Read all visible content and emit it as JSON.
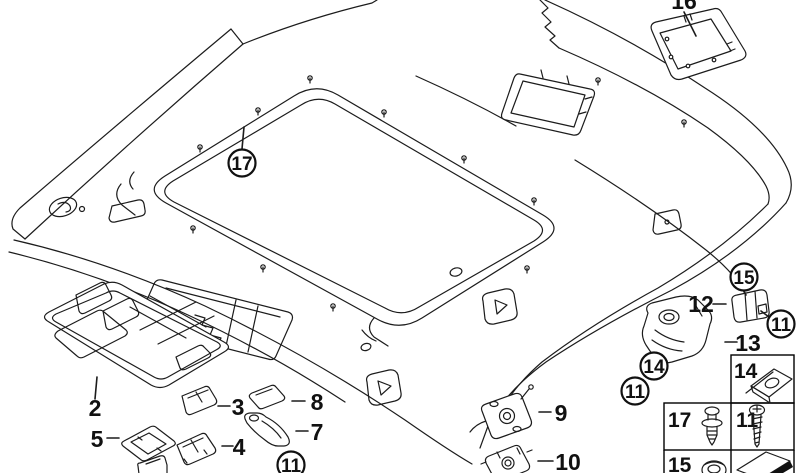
{
  "diagram": {
    "ink": "#1c1c1c",
    "callouts": {
      "sunroof_trim": "17",
      "bracket_nut": "15",
      "bracket_screw": "11",
      "mount_nut": "14",
      "mount_screw": "11",
      "handle_screw": "11"
    },
    "part_labels": {
      "console": "2",
      "lens_rear": "3",
      "lens_front": "4",
      "frame": "5",
      "grab_handle": "7",
      "pad": "8",
      "plate": "9",
      "bracket_rear": "10",
      "clip_bracket": "12",
      "handle_mount": "13",
      "panel": "16"
    },
    "legend": {
      "speed_nut": "14",
      "expansion_rivet": "17",
      "screw": "11",
      "plastic_nut": "15"
    }
  }
}
